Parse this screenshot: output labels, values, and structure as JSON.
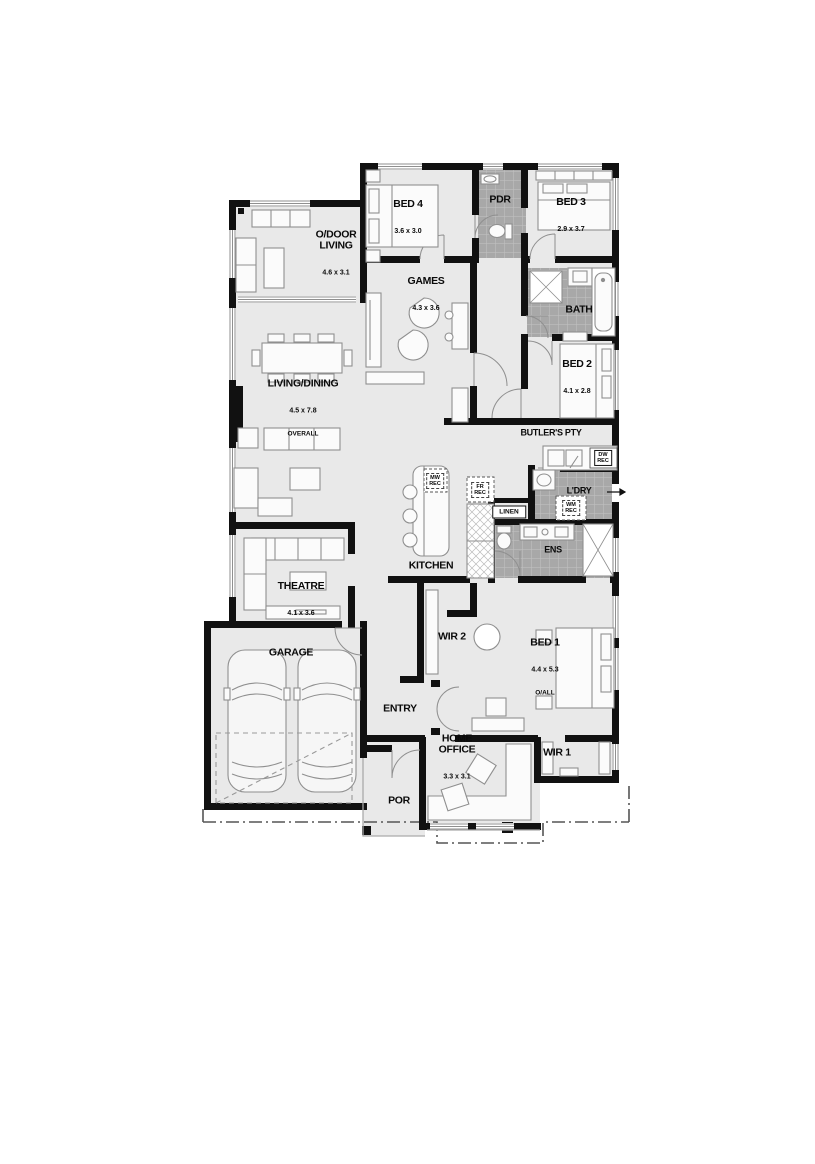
{
  "title": "Single storey home floor plan",
  "colors": {
    "wall": "#111111",
    "floor": "#e9e9e9",
    "wet_area_tile": "#a8a8a8",
    "tile_grout": "#c3c3c3",
    "furniture_line": "#8f8f8f",
    "boundary_line": "#555555",
    "background": "#ffffff"
  },
  "rooms": {
    "bed4": {
      "name": "BED 4",
      "dims": "3.6 x 3.0"
    },
    "pdr": {
      "name": "PDR"
    },
    "bed3": {
      "name": "BED 3",
      "dims": "2.9 x 3.7"
    },
    "odoor_living": {
      "name": "O/DOOR\nLIVING",
      "dims": "4.6 x 3.1"
    },
    "games": {
      "name": "GAMES",
      "dims": "4.3 x 3.6"
    },
    "bath": {
      "name": "BATH"
    },
    "living_dining": {
      "name": "LIVING/DINING",
      "dims": "4.5 x 7.8",
      "sub": "OVERALL"
    },
    "bed2": {
      "name": "BED 2",
      "dims": "4.1 x 2.8"
    },
    "butlers_pty": {
      "name": "BUTLER'S PTY"
    },
    "ldry": {
      "name": "L'DRY"
    },
    "linen": {
      "name": "LINEN"
    },
    "ens": {
      "name": "ENS"
    },
    "kitchen": {
      "name": "KITCHEN"
    },
    "theatre": {
      "name": "THEATRE",
      "dims": "4.1 x 3.6"
    },
    "wir2": {
      "name": "WIR 2"
    },
    "bed1": {
      "name": "BED 1",
      "dims": "4.4 x 5.3",
      "sub": "O/ALL"
    },
    "garage": {
      "name": "GARAGE"
    },
    "entry": {
      "name": "ENTRY"
    },
    "home_office": {
      "name": "HOME\nOFFICE",
      "dims": "3.3 x 3.1"
    },
    "wir1": {
      "name": "WIR 1"
    },
    "por": {
      "name": "POR"
    }
  },
  "recesses": {
    "dw": "DW\nREC",
    "mw": "MW\nREC",
    "fr": "FR\nREC",
    "wm": "WM\nREC"
  }
}
